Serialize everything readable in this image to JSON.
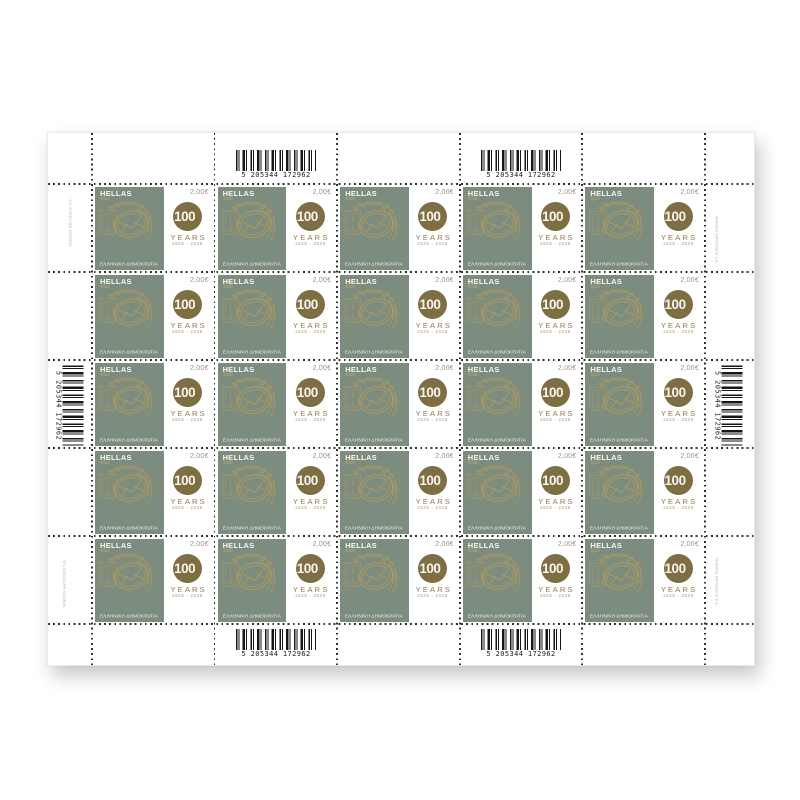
{
  "sheet": {
    "grid": {
      "rows": 5,
      "cols": 5
    },
    "stamp": {
      "country": "HELLAS",
      "year": "2026",
      "denomination": "2,00€",
      "republic_text": "ΕΛΛΗΝΙΚΗ ΔΗΜΟΚΡΑΤΙΑ",
      "emblem_letters": "FIP",
      "centenary": {
        "number": "100",
        "years": "YEARS",
        "dates": "1926 - 2026"
      }
    },
    "barcode_digits": "5 205344 172962",
    "printer_imprint": "VERIDOS MATSOUKIS S.A.",
    "colors": {
      "green": "#7c8d7f",
      "gold": "#b0985c",
      "gold_bright": "#c2a75f",
      "bronze": "#7d6e44",
      "bronze_mid": "#8a7a4b",
      "bronze_light": "#a6966d",
      "denom": "#9a9489",
      "perf": "#2f2f2f"
    }
  }
}
